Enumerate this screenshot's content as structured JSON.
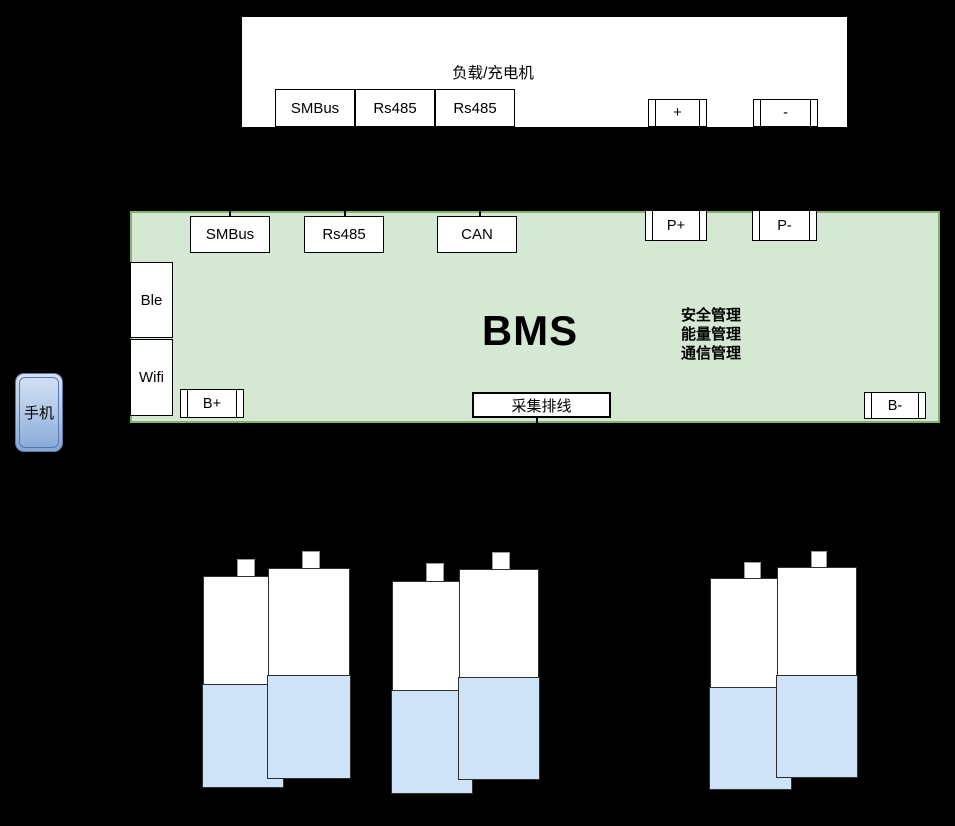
{
  "diagram_title": "BMS architecture diagram",
  "charger": {
    "title": "负载/充电机",
    "ports": [
      {
        "label": "SMBus"
      },
      {
        "label": "Rs485"
      },
      {
        "label": "Rs485"
      }
    ],
    "terminals": [
      {
        "label": "+"
      },
      {
        "label": "-"
      }
    ]
  },
  "bms": {
    "title": "BMS",
    "comm_ports": [
      {
        "label": "SMBus"
      },
      {
        "label": "Rs485"
      },
      {
        "label": "CAN"
      }
    ],
    "power_ports": [
      {
        "label": "P+"
      },
      {
        "label": "P-"
      }
    ],
    "wireless_ports": [
      {
        "label": "Ble"
      },
      {
        "label": "Wifi"
      }
    ],
    "battery_ports": [
      {
        "label": "B+"
      },
      {
        "label": "采集排线"
      },
      {
        "label": "B-"
      }
    ],
    "functions": [
      "安全管理",
      "能量管理",
      "通信管理"
    ]
  },
  "phone": {
    "label": "手机"
  },
  "battery_pack": {
    "cell_count": 6,
    "group_count": 3
  },
  "colors": {
    "background": "#000000",
    "bms_fill": "#d5e8d4",
    "bms_border": "#82b366",
    "battery_fill": "#cfe3f8",
    "phone_gradient_top": "#d4e1f5",
    "phone_gradient_bottom": "#84a8d8",
    "box_fill": "#ffffff",
    "line": "#000000"
  }
}
